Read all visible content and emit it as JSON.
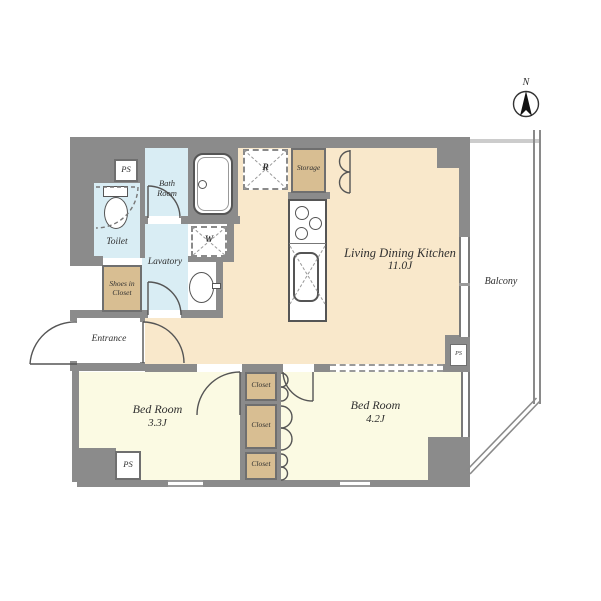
{
  "compass": {
    "north_label": "N"
  },
  "rooms": {
    "ldk": {
      "name": "Living Dining Kitchen",
      "size": "11.0J"
    },
    "bedroom_33": {
      "name": "Bed Room",
      "size": "3.3J"
    },
    "bedroom_42": {
      "name": "Bed Room",
      "size": "4.2J"
    },
    "balcony": {
      "name": "Balcony"
    },
    "entrance": {
      "name": "Entrance"
    },
    "toilet": {
      "name": "Toilet"
    },
    "bathroom": {
      "line1": "Bath",
      "line2": "Room"
    },
    "lavatory": {
      "name": "Lavatory"
    },
    "storage": {
      "name": "Storage"
    },
    "shoes_closet": {
      "line1": "Shoes in",
      "line2": "Closet"
    },
    "closet_top": {
      "name": "Closet"
    },
    "closet_mid": {
      "name": "Closet"
    },
    "closet_bottom": {
      "name": "Closet"
    }
  },
  "labels": {
    "ps_top": "PS",
    "ps_bottom": "PS",
    "ps_right": "PS",
    "washer": "W",
    "refrigerator": "R"
  },
  "colors": {
    "wall": "#8b8b8b",
    "ldk_floor": "#f9e8cb",
    "bedroom_floor": "#fbfae3",
    "wet_floor": "#d9edf4",
    "closet_fill": "#d8be92",
    "fixture_line": "#555555",
    "balcony_top_line": "#cccccc"
  }
}
